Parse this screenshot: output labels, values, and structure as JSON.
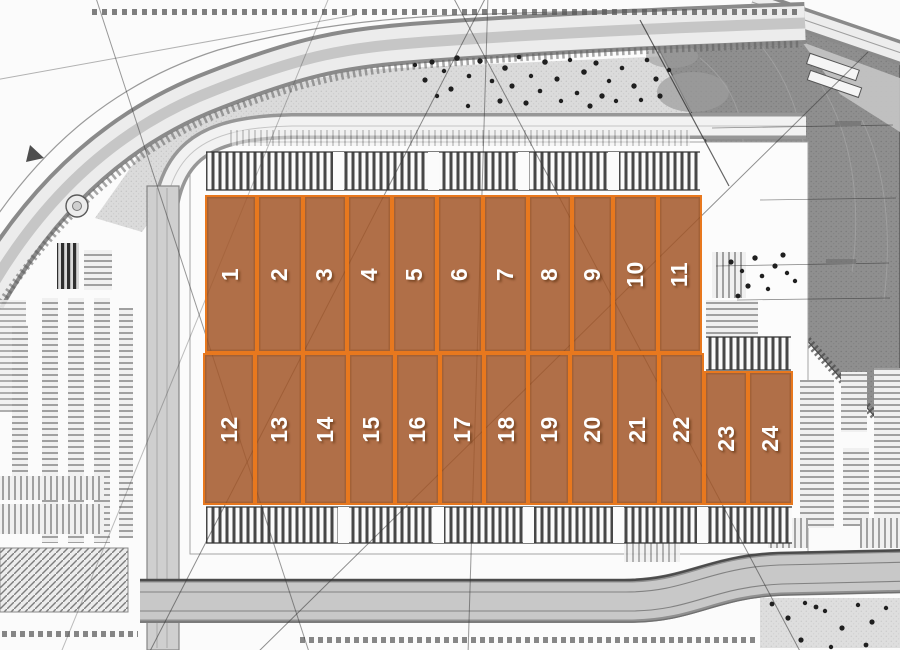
{
  "site_plan": {
    "unit_count": 24,
    "colors": {
      "unit_border": "#E8781E",
      "unit_fill": "rgba(162,86,40,0.85)",
      "unit_label": "#FFFFFF"
    },
    "units": [
      {
        "label": "1",
        "row": "top"
      },
      {
        "label": "2",
        "row": "top"
      },
      {
        "label": "3",
        "row": "top"
      },
      {
        "label": "4",
        "row": "top"
      },
      {
        "label": "5",
        "row": "top"
      },
      {
        "label": "6",
        "row": "top"
      },
      {
        "label": "7",
        "row": "top"
      },
      {
        "label": "8",
        "row": "top"
      },
      {
        "label": "9",
        "row": "top"
      },
      {
        "label": "10",
        "row": "top"
      },
      {
        "label": "11",
        "row": "top"
      },
      {
        "label": "12",
        "row": "bottom"
      },
      {
        "label": "13",
        "row": "bottom"
      },
      {
        "label": "14",
        "row": "bottom"
      },
      {
        "label": "15",
        "row": "bottom"
      },
      {
        "label": "16",
        "row": "bottom"
      },
      {
        "label": "17",
        "row": "bottom"
      },
      {
        "label": "18",
        "row": "bottom"
      },
      {
        "label": "19",
        "row": "bottom"
      },
      {
        "label": "20",
        "row": "bottom"
      },
      {
        "label": "21",
        "row": "bottom"
      },
      {
        "label": "22",
        "row": "bottom"
      },
      {
        "label": "23",
        "row": "bottom"
      },
      {
        "label": "24",
        "row": "bottom"
      }
    ]
  }
}
